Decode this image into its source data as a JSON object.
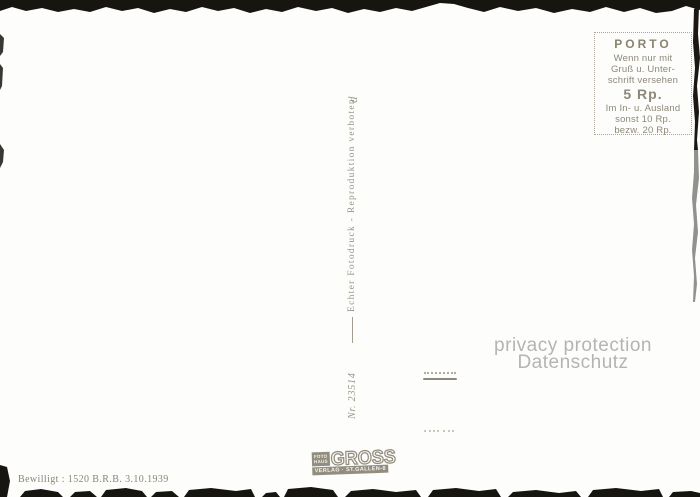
{
  "porto": {
    "title": "PORTO",
    "lines": [
      "Wenn nur mit",
      "Gruß u. Unter-",
      "schrift versehen"
    ],
    "price": "5 Rp.",
    "lines2": [
      "Im In- u. Ausland",
      "sonst 10 Rp.",
      "bezw. 20 Rp."
    ]
  },
  "spine": {
    "imprint": "Echter Fotodruck - Reproduktion verboten",
    "flourish": "d",
    "serial": "Nr. 23514"
  },
  "footer": {
    "permit": "Bewilligt : 1520  B.R.B.  3.10.1939"
  },
  "publisher": {
    "small1": "FOTO",
    "small2": "HAUS",
    "name": "GROSS",
    "subline": "VERLAG · ST.GALLEN-8"
  },
  "watermark": {
    "line1": "privacy protection",
    "line2": "Datenschutz"
  },
  "colors": {
    "paper": "#fdfdfc",
    "ink": "#8d8879",
    "ink_dark": "#89846f",
    "spine_ink": "#9a9486",
    "watermark_gray": "#b4b4b4",
    "edge_black": "#17150f"
  }
}
